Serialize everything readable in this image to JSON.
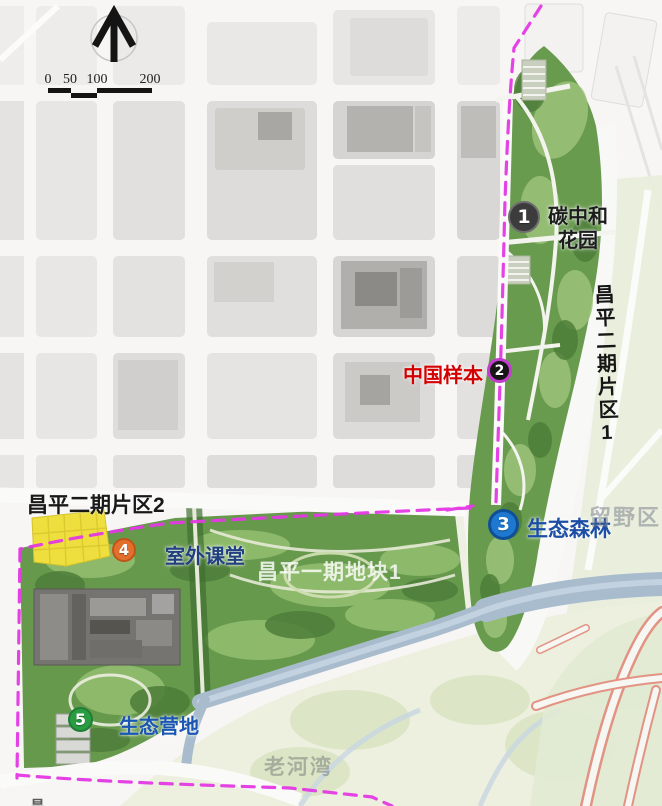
{
  "scalebar": {
    "labels": [
      "0",
      "50",
      "100",
      "200"
    ]
  },
  "markers": [
    {
      "num": "1",
      "label": "碳中和花园",
      "label_lines": [
        "碳中和",
        "花园"
      ],
      "badge_color": "#3c3c3c",
      "ring_color": "#6e6e6e",
      "label_color": "#1c1c1c"
    },
    {
      "num": "2",
      "label": "中国样本",
      "badge_color": "#161616",
      "ring_color": "#c43cd0",
      "label_color": "#d40000"
    },
    {
      "num": "3",
      "label": "生态森林",
      "badge_color": "#1e78cf",
      "ring_color": "#0f4f97",
      "label_color": "#1b4ea4"
    },
    {
      "num": "4",
      "label": "室外课堂",
      "badge_color": "#e2702c",
      "ring_color": "#c05518",
      "label_color": "#20407f"
    },
    {
      "num": "5",
      "label": "生态营地",
      "badge_color": "#2a9c42",
      "ring_color": "#1e7f35",
      "label_color": "#1956b2"
    }
  ],
  "labels": {
    "district2": "昌平二期片区2",
    "district1": "昌平二期片区1",
    "phase1_block1": "昌平一期地块1",
    "wild_area": "留野区",
    "old_river_bay": "老河湾",
    "corner_partial": "昌"
  },
  "colors": {
    "boundary_dashed": "#e438e4",
    "park_green": "#699b4f",
    "river_blue": "#a9bccd",
    "field_yellow": "#efdf3e"
  }
}
